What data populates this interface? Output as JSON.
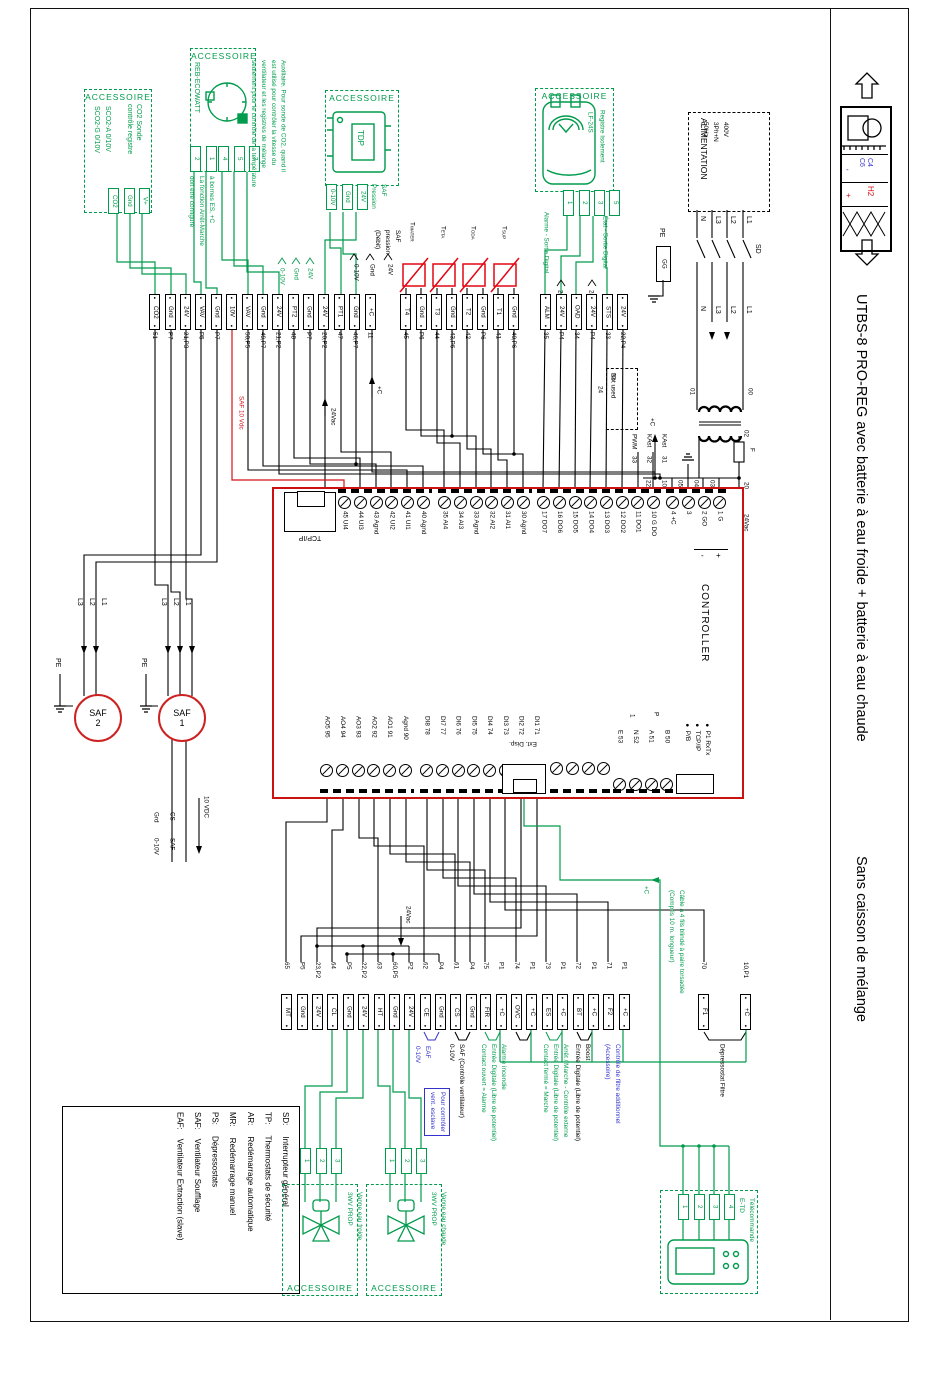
{
  "frame": {
    "title1": "UTBS-8 PRO-REG  avec batterie à eau froide + batterie à eau chaude",
    "title2": "Sans caisson de mélange"
  },
  "acc": "ACCESSOIRE",
  "unit": {
    "c4": "C4",
    "c6": "C6",
    "minus": "-",
    "h2": "H2",
    "plus": "+"
  },
  "co2": {
    "l1": "CO2  Sonde",
    "l2": "contrôle registre",
    "l3": "SCO2-A  0/10V",
    "l4": "SCO2-G  0/10V",
    "cells": [
      {
        "t": "CO2"
      },
      {
        "t": "Gnd"
      },
      {
        "t": "V+"
      }
    ]
  },
  "eco": {
    "name": "REB-ECOWATT",
    "cellsA": [
      {
        "t": "2"
      },
      {
        "t": "1"
      }
    ],
    "cellsB": [
      {
        "t": "4"
      },
      {
        "t": "5"
      },
      {
        "t": "3"
      }
    ],
    "noteA": [
      "à bornes ES, +C",
      "La fonction Arrêt-Marche",
      "doit être configuré"
    ],
    "noteB": [
      "Auxiliaire. Pour sonde de CO2, quand il",
      "est utilisé pour contrôler la vitesse du",
      "ventilateur et les registres de mélange",
      "seulement pour le contrôle de la température"
    ],
    "wl": [
      "0-10V",
      "Gnd",
      "24V"
    ]
  },
  "tdp": {
    "name": "TDP",
    "label": [
      "SAF",
      "Pression"
    ],
    "cells": [
      {
        "t": "0-10V"
      },
      {
        "t": "Gnd"
      },
      {
        "t": "24V"
      }
    ],
    "br": [
      "SAF",
      "pression",
      "(Débit)"
    ],
    "wl": [
      "0-10V",
      "Gnd",
      "24V"
    ]
  },
  "lf": {
    "l1": "Registre Isolement",
    "l2": "LF-24S",
    "cells": [
      {
        "t": "1"
      },
      {
        "t": "2"
      },
      {
        "t": "3"
      },
      {
        "t": "5"
      }
    ],
    "alarme": "Alarme - Sortie Digital",
    "etat": "État - Sortie Digital",
    "v24": "24V"
  },
  "alim": {
    "h": "ALIMENTATION",
    "specs": [
      "400V",
      "3Ph+N",
      "50Hz"
    ],
    "ph": [
      "N",
      "L3",
      "L2",
      "L1"
    ],
    "sd": "SD",
    "pe": "PE",
    "gg": "GG"
  },
  "pw": {
    "n00": "00",
    "n01": "01",
    "n02": "02",
    "f": "F",
    "n20": "20",
    "vac": "24Vac",
    "n03": "03",
    "n04": "04",
    "n05": "05",
    "n10": "10",
    "n22": "22",
    "pc": "+C"
  },
  "sens": [
    {
      "m": "T",
      "s": "WATER"
    },
    {
      "m": "T",
      "s": "ETA"
    },
    {
      "m": "T",
      "s": "ODA"
    },
    {
      "m": "T",
      "s": "SUP"
    }
  ],
  "g1": [
    {
      "t": "CO2",
      "n": "51"
    },
    {
      "t": "Gnd",
      "n": "P7"
    },
    {
      "t": "24V",
      "n": "21,P3"
    },
    {
      "t": "VAV",
      "n": "P5"
    },
    {
      "t": "Gnd",
      "n": "P7"
    },
    {
      "t": "10V",
      "n": ""
    },
    {
      "t": "VAV",
      "n": "50,P5"
    },
    {
      "t": "Gnd",
      "n": "49,P7"
    },
    {
      "t": "24V",
      "n": "21,P2"
    },
    {
      "t": "PT2",
      "n": "48"
    },
    {
      "t": "Gnd",
      "n": "P7"
    },
    {
      "t": "24V",
      "n": "20,P2"
    },
    {
      "t": "PT1",
      "n": "47"
    },
    {
      "t": "Gnd",
      "n": "46,P7"
    },
    {
      "t": "+C",
      "n": "11"
    }
  ],
  "g2": [
    {
      "t": "T4",
      "n": "45"
    },
    {
      "t": "Gnd",
      "n": "P6"
    },
    {
      "t": "T3",
      "n": "44"
    },
    {
      "t": "Gnd",
      "n": "43,P6"
    },
    {
      "t": "T2",
      "n": "42"
    },
    {
      "t": "Gnd",
      "n": "P6"
    },
    {
      "t": "T1",
      "n": "41"
    },
    {
      "t": "Gnd",
      "n": "40,P6"
    }
  ],
  "g3": [
    {
      "t": "ALM",
      "n": "35"
    },
    {
      "t": "24V",
      "n": "P4"
    },
    {
      "t": "OAD",
      "n": "34"
    },
    {
      "t": "24V",
      "n": "P4"
    },
    {
      "t": "STS",
      "n": "33"
    },
    {
      "t": "24V",
      "n": "22,P4"
    }
  ],
  "ctl": {
    "name": "CONTROLLER",
    "tcp": "TCP/IP",
    "ext": "Ext. Disp.",
    "ui": [
      "45 UI4",
      "44 UI3",
      "43 Agnd",
      "42 UI2",
      "41 UI1",
      "40 Agnd"
    ],
    "ai": [
      "35 AI4",
      "34 AI3",
      "33 Agnd",
      "32 AI2",
      "31 AI1",
      "30 Agnd"
    ],
    "dob": [
      "17 DO7",
      "16 DO6",
      "15 DO5",
      "14 DO4",
      "13 DO3",
      "12 DO2",
      "11 DO1",
      "10 G DO"
    ],
    "pwr": [
      "4 +C",
      "3",
      "2 GO",
      "1 G"
    ],
    "minus": "-",
    "plus": "+",
    "ao": [
      "AO5 95",
      "AO4 94",
      "AO3 93",
      "AO2 92",
      "AO1 91",
      "Agnd 90"
    ],
    "di": [
      "DI8 78",
      "DI7 77",
      "DI6 76",
      "DI5 75",
      "DI4 74",
      "DI3 73",
      "DI2 72",
      "DI1 71"
    ],
    "comm": [
      "E 53",
      "N 52",
      "A 51",
      "B 50"
    ],
    "p": "P",
    "one": "1",
    "leds": [
      "P1 RxTx",
      "TCP/IP",
      "P/B"
    ]
  },
  "nu": {
    "t": "Not used",
    "a": "24",
    "b": "23",
    "w": [
      {
        "t": "PWM",
        "n": "33"
      },
      {
        "t": "KAst",
        "n": "32"
      },
      {
        "t": "KAst",
        "n": "31"
      }
    ]
  },
  "fans": {
    "saf": "SAF",
    "n1": "1",
    "n2": "2",
    "ph": [
      "L3",
      "L2",
      "L1"
    ],
    "pe": "PE"
  },
  "slave": {
    "vdc": "10 VDC",
    "a": "CS",
    "b": "SAF",
    "c": "Grd",
    "d": "0-10V"
  },
  "b1": [
    {
      "t": "MT",
      "n": "65"
    },
    {
      "t": "Gnd",
      "n": "P5"
    },
    {
      "t": "24V",
      "n": "23,P2"
    },
    {
      "t": "CL",
      "n": "64"
    },
    {
      "t": "Gnd",
      "n": "P5"
    },
    {
      "t": "24V",
      "n": "22,P2"
    },
    {
      "t": "HT",
      "n": "63"
    },
    {
      "t": "Gnd",
      "n": "60,P5"
    },
    {
      "t": "24V",
      "n": "P2"
    },
    {
      "t": "CE",
      "n": "62"
    },
    {
      "t": "Gnd",
      "n": "P4"
    },
    {
      "t": "CS",
      "n": "61"
    },
    {
      "t": "Gnd",
      "n": "P4"
    }
  ],
  "b2": [
    {
      "t": "FIR",
      "n": "75"
    },
    {
      "t": "+C",
      "n": "P1"
    },
    {
      "t": "OVC",
      "n": "74"
    },
    {
      "t": "+C",
      "n": "P1"
    },
    {
      "t": "ES",
      "n": "73"
    },
    {
      "t": "+C",
      "n": "P1"
    },
    {
      "t": "BT",
      "n": "72"
    },
    {
      "t": "+C",
      "n": "P1"
    },
    {
      "t": "F2",
      "n": "71"
    },
    {
      "t": "+C",
      "n": "P1"
    }
  ],
  "b3a": [
    {
      "t": "F1",
      "n": "70"
    }
  ],
  "b3b": [
    {
      "t": "+C",
      "n": "10,P1"
    }
  ],
  "ann": {
    "safctl": [
      "SAF  (Contrôle ventilateur)",
      "0-10V"
    ],
    "eaf": [
      "EAF",
      "0-10V"
    ],
    "eafbox": [
      "Pour contrôler",
      "vent. esclave"
    ],
    "fire": [
      "Alarme incendie",
      "Entrée Digitale (Libre de potentiel)",
      "Contact ouvert = Alarme"
    ],
    "run": [
      "Arrêt / Marche - Contrôle externe",
      "Entrée Digitale (Libre de potentiel)",
      "Contact fermé = Marche"
    ],
    "boost": [
      "Boost",
      "Entrée Digitale (Libre de potentiel)"
    ],
    "filt": [
      "Contrôle de filtre additionnel",
      "(Accessoire)"
    ],
    "dep": "Dépressostat Filtre",
    "vac": "24Vac"
  },
  "valves": {
    "cold": [
      "Vanne eau froide",
      "3WV PROP"
    ],
    "hot": [
      "Vanne eau chaude",
      "3WV PROP"
    ],
    "cells": [
      {
        "t": "1"
      },
      {
        "t": "2"
      },
      {
        "t": "3"
      }
    ]
  },
  "etd": {
    "label": [
      "Télécommande",
      "E-TD"
    ],
    "cells": [
      {
        "t": "1"
      },
      {
        "t": "2"
      },
      {
        "t": "3"
      },
      {
        "t": "4"
      }
    ]
  },
  "cable": [
    "Câble à 4 fils blindé à paire torsadée",
    "(Compris 10 m. longueur)"
  ],
  "cpc": "+C",
  "red_label": "SAF  10 Vdc",
  "legend": [
    {
      "k": "SD:",
      "v": "Interrupteur général"
    },
    {
      "k": "TP:",
      "v": "Thermostats de sécurité"
    },
    {
      "k": "AR:",
      "v": "Redémarrage automatique"
    },
    {
      "k": "MR:",
      "v": "Redémarrage manuel"
    },
    {
      "k": "PS:",
      "v": "Dépressostats"
    },
    {
      "k": "SAF:",
      "v": "Ventilateur Soufflage"
    },
    {
      "k": "EAF:",
      "v": "Ventilateur Extraction (slave)"
    }
  ]
}
